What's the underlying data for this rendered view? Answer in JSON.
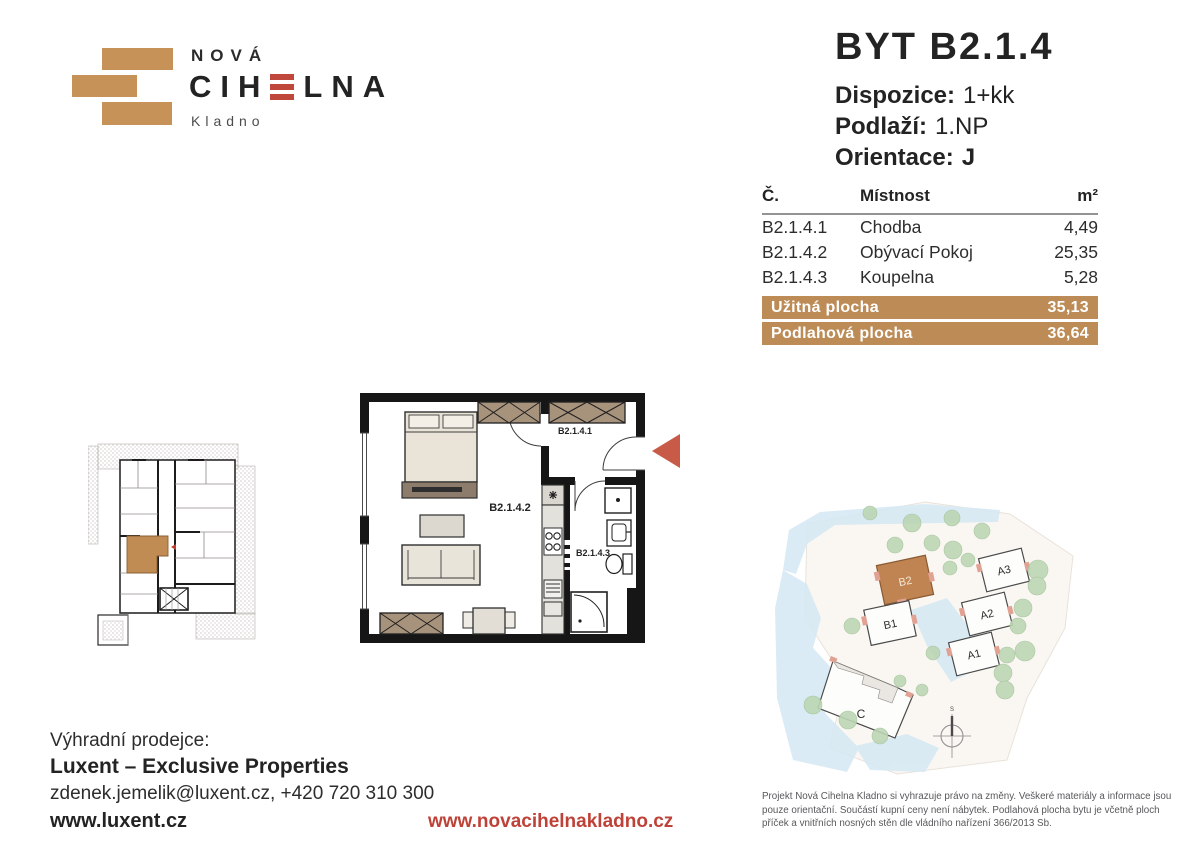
{
  "brand": {
    "name_top": "NOVÁ",
    "name_mid_left": "CIH",
    "name_mid_right": "LNA",
    "city": "Kladno"
  },
  "unit": {
    "title": "BYT B2.1.4",
    "specs": [
      {
        "label": "Dispozice:",
        "value": "1+kk"
      },
      {
        "label": "Podlaží:",
        "value": "1.NP"
      },
      {
        "label": "Orientace:",
        "value": "J"
      }
    ]
  },
  "room_table": {
    "headers": {
      "number": "Č.",
      "name": "Místnost",
      "area": "m²"
    },
    "rows": [
      {
        "number": "B2.1.4.1",
        "name": "Chodba",
        "area": "4,49"
      },
      {
        "number": "B2.1.4.2",
        "name": "Obývací Pokoj",
        "area": "25,35"
      },
      {
        "number": "B2.1.4.3",
        "name": "Koupelna",
        "area": "5,28"
      }
    ],
    "totals": [
      {
        "label": "Užitná plocha",
        "value": "35,13"
      },
      {
        "label": "Podlahová plocha",
        "value": "36,64"
      }
    ]
  },
  "floorplan": {
    "labels": {
      "hall": "B2.1.4.1",
      "living": "B2.1.4.2",
      "bath": "B2.1.4.3"
    }
  },
  "sitemap": {
    "buildings": [
      {
        "id": "B2"
      },
      {
        "id": "B1"
      },
      {
        "id": "A3"
      },
      {
        "id": "A2"
      },
      {
        "id": "A1"
      },
      {
        "id": "C"
      }
    ],
    "compass_label": "S"
  },
  "footer": {
    "seller_intro": "Výhradní prodejce:",
    "seller_name": "Luxent – Exclusive Properties",
    "seller_contact": "zdenek.jemelik@luxent.cz, +420 720 310 300",
    "seller_web": "www.luxent.cz",
    "project_web": "www.novacihelnakladno.cz",
    "disclaimer": "Projekt Nová Cihelna Kladno si vyhrazuje právo na změny. Veškeré materiály a informace jsou pouze orientační. Součástí kupní ceny není nábytek. Podlahová plocha bytu je včetně ploch příček a vnitřních nosných stěn dle vládního nařízení 366/2013 Sb."
  },
  "colors": {
    "brick": "#c79257",
    "table_bar": "#bd8b55",
    "logo_red": "#c0473b",
    "link_red": "#bf4238",
    "arrow_red": "#c75b48",
    "text_dark": "#232323",
    "text_gray": "#57585a"
  }
}
